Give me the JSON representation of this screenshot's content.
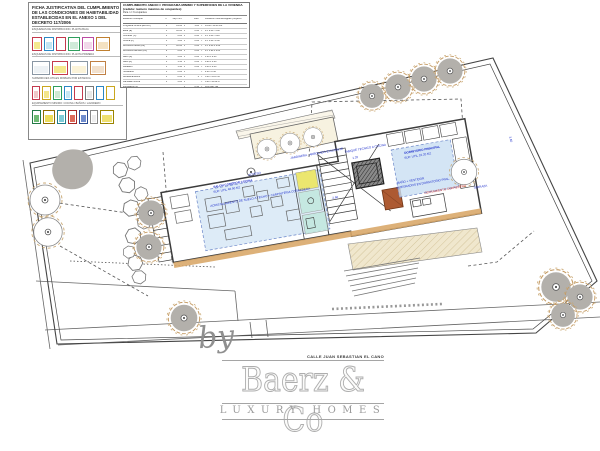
{
  "legend": {
    "title": "FICHA JUSTIFICATIVA DEL CUMPLIMIENTO DE LAS CONDICIONES DE HABITABILIDAD ESTABLECIDAS EN EL ANEXO 1 DEL DECRETO 117/2006",
    "sections": [
      {
        "label": "ESQUEMAS DE DISTRIBUCION. PLANTA BAJA",
        "icons": [
          {
            "b": "#c43a4e",
            "f": "#f5e88e",
            "w": 10
          },
          {
            "b": "#2b87c4",
            "f": "#c3e4f2",
            "w": 10
          },
          {
            "b": "#c43a4e",
            "f": "#ffffff",
            "w": 10
          },
          {
            "b": "#2f9e5d",
            "f": "#d0ead9",
            "w": 12
          },
          {
            "b": "#bb4aa2",
            "f": "#f1d8ea",
            "w": 12
          },
          {
            "b": "#c08030",
            "f": "#f4e2c2",
            "w": 14
          }
        ]
      },
      {
        "label": "ESQUEMAS DE DISTRIBUCION. PLANTA PRIMERA",
        "icons": [
          {
            "b": "#8a97a4",
            "f": "#eef2f5",
            "w": 18
          },
          {
            "b": "#c43a4e",
            "f": "#f5e88e",
            "w": 16
          },
          {
            "b": "#8a97a4",
            "f": "#fbf3d9",
            "w": 18
          },
          {
            "b": "#c08044",
            "f": "#f2e0cc",
            "w": 16
          }
        ]
      },
      {
        "label": "SUPERFICIES UTILES MINIMAS POR ESTANCIA",
        "icons": [
          {
            "b": "#c43a4e",
            "f": "#f0c8c8",
            "w": 8
          },
          {
            "b": "#caa61e",
            "f": "#f3e68a",
            "w": 9
          },
          {
            "b": "#2f9e5d",
            "f": "#cfe9d3",
            "w": 9
          },
          {
            "b": "#2b87c4",
            "f": "#c9e6f2",
            "w": 8
          },
          {
            "b": "#c43a4e",
            "f": "#ffffff",
            "w": 9
          },
          {
            "b": "#777777",
            "f": "#e8e8e8",
            "w": 9
          },
          {
            "b": "#2b87c4",
            "f": "#ffffff",
            "w": 8
          },
          {
            "b": "#caa61e",
            "f": "#ffffff",
            "w": 9
          }
        ]
      },
      {
        "label": "EQUIPAMIENTO MINIMO: COCINA / BAÑOS / LAVADERO",
        "icons": [
          {
            "b": "#237a46",
            "f": "#6fbb74",
            "w": 9
          },
          {
            "b": "#8f6d00",
            "f": "#ecdd5a",
            "w": 12
          },
          {
            "b": "#1f7d8c",
            "f": "#7fccd8",
            "w": 9
          },
          {
            "b": "#a62828",
            "f": "#dd6a5a",
            "w": 9
          },
          {
            "b": "#2a4a90",
            "f": "#6f8ccd",
            "w": 9
          },
          {
            "b": "#888888",
            "f": "#eeeeee",
            "w": 8
          },
          {
            "b": "#9a8400",
            "f": "#efe070",
            "w": 14
          }
        ]
      }
    ]
  },
  "spec_table": {
    "title": "CUMPLIMIENTO ANEXO I: PROGRAMA MINIMO Y SUPERFICIES DE LA VIVIENDA (cedula: numero maximo de ocupantes)",
    "subtitle": "Para n = 6 ocupantes",
    "col_headers": [
      "estancia / concepto",
      "n°",
      "sup. min.",
      "",
      "coef.",
      "",
      "condicion minima exigida / proyecto"
    ],
    "rows": [
      {
        "label": "Programa minimo (E+C+K)",
        "c": [
          "1",
          "14.00",
          "x",
          "1.00",
          "=",
          "14.00 / 48.50 m2"
        ]
      },
      {
        "label": "Estar (E)",
        "c": [
          "1",
          "10.00",
          "x",
          "0.60",
          "=",
          "d ≥ 2.60 / 5.40"
        ]
      },
      {
        "label": "Comedor (C)",
        "c": [
          "1",
          "6.00",
          "x",
          "0.60",
          "=",
          "d ≥ 1.80 / 3.20"
        ]
      },
      {
        "label": "Cocina (K)",
        "c": [
          "1",
          "5.00",
          "x",
          "0.08",
          "=",
          "d ≥ 1.60 / 2.40"
        ]
      },
      {
        "label": "Dormitorio doble (D2)",
        "c": [
          "1",
          "10.00",
          "x",
          "0.08",
          "=",
          "d ≥ 2.60 x 2.60"
        ]
      },
      {
        "label": "Dormitorio sencillo (D1)",
        "c": [
          "2",
          "6.00",
          "x",
          "0.08",
          "=",
          "d ≥ 1.90 x 2.05"
        ]
      },
      {
        "label": "Baño (B)",
        "c": [
          "2",
          "3.00",
          "x",
          "0.08",
          "=",
          "1.20 x 2.20"
        ]
      },
      {
        "label": "Aseo (A)",
        "c": [
          "1",
          "1.50",
          "x",
          "0.08",
          "=",
          "0.90 x 1.20"
        ]
      },
      {
        "label": "Lavadero",
        "c": [
          "1",
          "1.40",
          "x",
          "0.08",
          "=",
          "0.60 x 0.60"
        ]
      },
      {
        "label": "Tendedero",
        "c": [
          "1",
          "2.00",
          "x",
          "",
          "=",
          "2.00 / 2.40"
        ]
      },
      {
        "label": "Almacenamiento",
        "c": [
          "1",
          "0.60",
          "x",
          "6",
          "=",
          "3.60 / 4.10 m3"
        ]
      },
      {
        "label": "Fachada minima",
        "c": [
          "1",
          "3.00",
          "x",
          "",
          "=",
          "3.00 / 12.60 m"
        ]
      },
      {
        "label": "Iluminacion (1)",
        "c": [
          "",
          "",
          "x",
          "0.10",
          "=",
          "10% sup. util"
        ]
      },
      {
        "label": "Ventilacion (2)",
        "c": [
          "",
          "",
          "x",
          "0.05",
          "=",
          "5% sup. util"
        ]
      },
      {
        "label": "Altura libre minima",
        "c": [
          "1",
          "2.50",
          "x",
          "",
          "=",
          "2.50 / 2.70 m"
        ]
      },
      {
        "label": "Aparatos sanitarios",
        "c": [
          "3",
          "",
          "x",
          "",
          "=",
          "lavabo+inodoro+ducha"
        ]
      },
      {
        "label": "Dotacion cocina",
        "c": [
          "1",
          "",
          "x",
          "",
          "=",
          "fregadero + coccion"
        ]
      }
    ]
  },
  "annotations": [
    {
      "x": 290,
      "y": 156,
      "rot": -10,
      "color": "#2233cc",
      "size": 3,
      "bold": 0,
      "text": "JARDINERA - ARBOLADO EXISTENTE"
    },
    {
      "x": 248,
      "y": 173,
      "rot": -10,
      "color": "#2233cc",
      "size": 3,
      "bold": 0,
      "text": "ACCESO"
    },
    {
      "x": 213,
      "y": 185,
      "rot": -10,
      "color": "#2233cc",
      "size": 3,
      "bold": 1,
      "text": "SALON COMEDOR COCINA"
    },
    {
      "x": 213,
      "y": 190,
      "rot": -10,
      "color": "#2233cc",
      "size": 3,
      "bold": 0,
      "text": "SUP. UTIL 48.50 M2"
    },
    {
      "x": 210,
      "y": 204,
      "rot": -10,
      "color": "#2233cc",
      "size": 3,
      "bold": 0,
      "text": "ACRISTALAMIENTO DE SUELO A TECHO + CARPINTERIA CORREDERA"
    },
    {
      "x": 344,
      "y": 150,
      "rot": -10,
      "color": "#2233cc",
      "size": 3,
      "bold": 0,
      "text": "TABIQUE TECNICO A COCINA"
    },
    {
      "x": 352,
      "y": 156,
      "rot": -10,
      "color": "#2233cc",
      "size": 3,
      "bold": 0,
      "text": "1.20"
    },
    {
      "x": 332,
      "y": 196,
      "rot": -10,
      "color": "#2233cc",
      "size": 3,
      "bold": 0,
      "text": "2.60"
    },
    {
      "x": 404,
      "y": 151,
      "rot": -10,
      "color": "#2233cc",
      "size": 3,
      "bold": 1,
      "text": "DORMITORIO PRINCIPAL"
    },
    {
      "x": 404,
      "y": 156,
      "rot": -10,
      "color": "#2233cc",
      "size": 3,
      "bold": 0,
      "text": "SUP. UTIL 16.20 M2"
    },
    {
      "x": 397,
      "y": 181,
      "rot": -10,
      "color": "#2233cc",
      "size": 3,
      "bold": 0,
      "text": "BAÑO + VESTIDOR"
    },
    {
      "x": 396,
      "y": 186,
      "rot": -10,
      "color": "#2233cc",
      "size": 3,
      "bold": 0,
      "text": "INTEGRADOS EN DORMITORIO PPAL."
    },
    {
      "x": 424,
      "y": 191,
      "rot": -10,
      "color": "#c03030",
      "size": 3,
      "bold": 0,
      "text": "CERRAMIENTO CORREDERO"
    },
    {
      "x": 473,
      "y": 186,
      "rot": -10,
      "color": "#2233cc",
      "size": 3,
      "bold": 0,
      "text": "TERRAZA"
    },
    {
      "x": 512,
      "y": 136,
      "rot": 76,
      "color": "#2233cc",
      "size": 3,
      "bold": 0,
      "text": "3.60"
    }
  ],
  "watermark": {
    "by": "by",
    "street": "CALLE JUAN SEBASTIAN EL CANO",
    "brand": "Baerz & Co",
    "tagline": "LUXURY HOMES"
  },
  "colors": {
    "highlight_blue": "#cfe2f4",
    "highlight_cyan": "#c2e8de",
    "highlight_yellow": "#ece55f",
    "annotation_blue": "#2233cc",
    "annotation_red": "#c03030",
    "tree_gray": "#b3b0ab",
    "tree_sketch": "#c49a62",
    "deck_beige": "#f0e7cd",
    "wood_edge": "#d9a96a",
    "watermark_gray": "#9b9b9b"
  }
}
